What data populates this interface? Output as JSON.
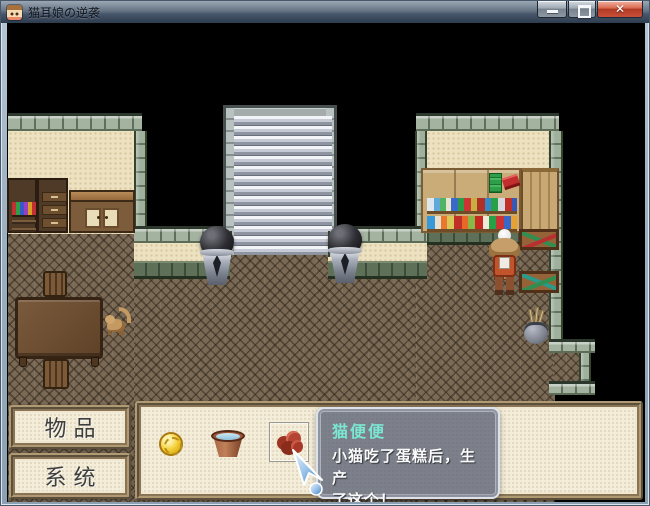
{
  "window": {
    "title": "猫耳娘の逆袭",
    "controls": [
      {
        "name": "minimize"
      },
      {
        "name": "maximize"
      },
      {
        "name": "close",
        "glyph": "✕"
      }
    ]
  },
  "hud": {
    "menu_buttons": [
      {
        "id": "items",
        "label": "物 品"
      },
      {
        "id": "system",
        "label": "系 统"
      }
    ],
    "inventory": {
      "items": [
        {
          "name": "gold-coin"
        },
        {
          "name": "water-bucket"
        },
        {
          "name": "cat-poop",
          "selected": true
        }
      ]
    }
  },
  "tooltip": {
    "title": "猫便便",
    "lines": [
      "小猫吃了蛋糕后，生产",
      "了这个！"
    ]
  },
  "colors": {
    "tooltip_title": "#7be6d2",
    "paper": "#f3edda",
    "close_button": "#c9503a",
    "wall_beige": "#ece1c0",
    "wall_trim_green": "#9fb09c",
    "floor_brown": "#7a6a55"
  }
}
